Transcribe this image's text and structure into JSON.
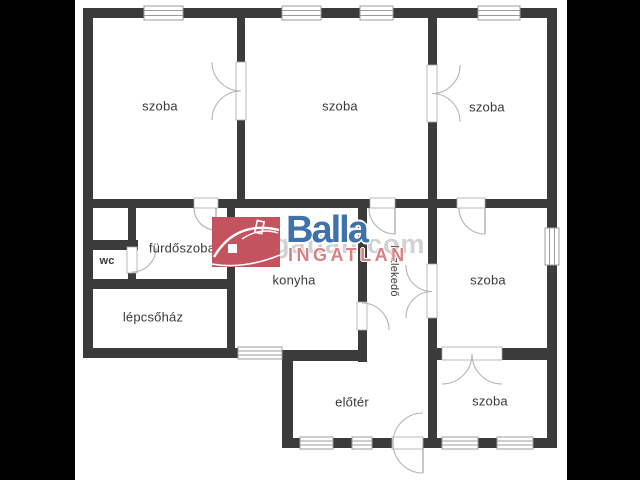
{
  "floorplan": {
    "rooms": [
      {
        "name": "room-top-left",
        "label": "szoba"
      },
      {
        "name": "room-top-middle",
        "label": "szoba"
      },
      {
        "name": "room-top-right",
        "label": "szoba"
      },
      {
        "name": "bathroom",
        "label": "fürdőszoba"
      },
      {
        "name": "wc",
        "label": "wc"
      },
      {
        "name": "stairwell",
        "label": "lépcsőház"
      },
      {
        "name": "kitchen",
        "label": "konyha"
      },
      {
        "name": "hallway",
        "label": "közlekedő"
      },
      {
        "name": "room-middle-right",
        "label": "szoba"
      },
      {
        "name": "foyer",
        "label": "előtér"
      },
      {
        "name": "room-bottom-right",
        "label": "szoba"
      }
    ],
    "branding": {
      "logo_text": "Balla",
      "logo_subtext": "INGATLAN",
      "watermark_text": "ingatlan.com",
      "logo_blue": "#3f71aa",
      "logo_box_red": "#c4535f",
      "logo_salmon": "#d98084"
    },
    "colors": {
      "wall": "#3b3b3b",
      "plan_background": "#ffffff",
      "letterbox": "#000000",
      "label_text": "#3a3a3a",
      "thin_line": "#9c9c9c"
    }
  }
}
